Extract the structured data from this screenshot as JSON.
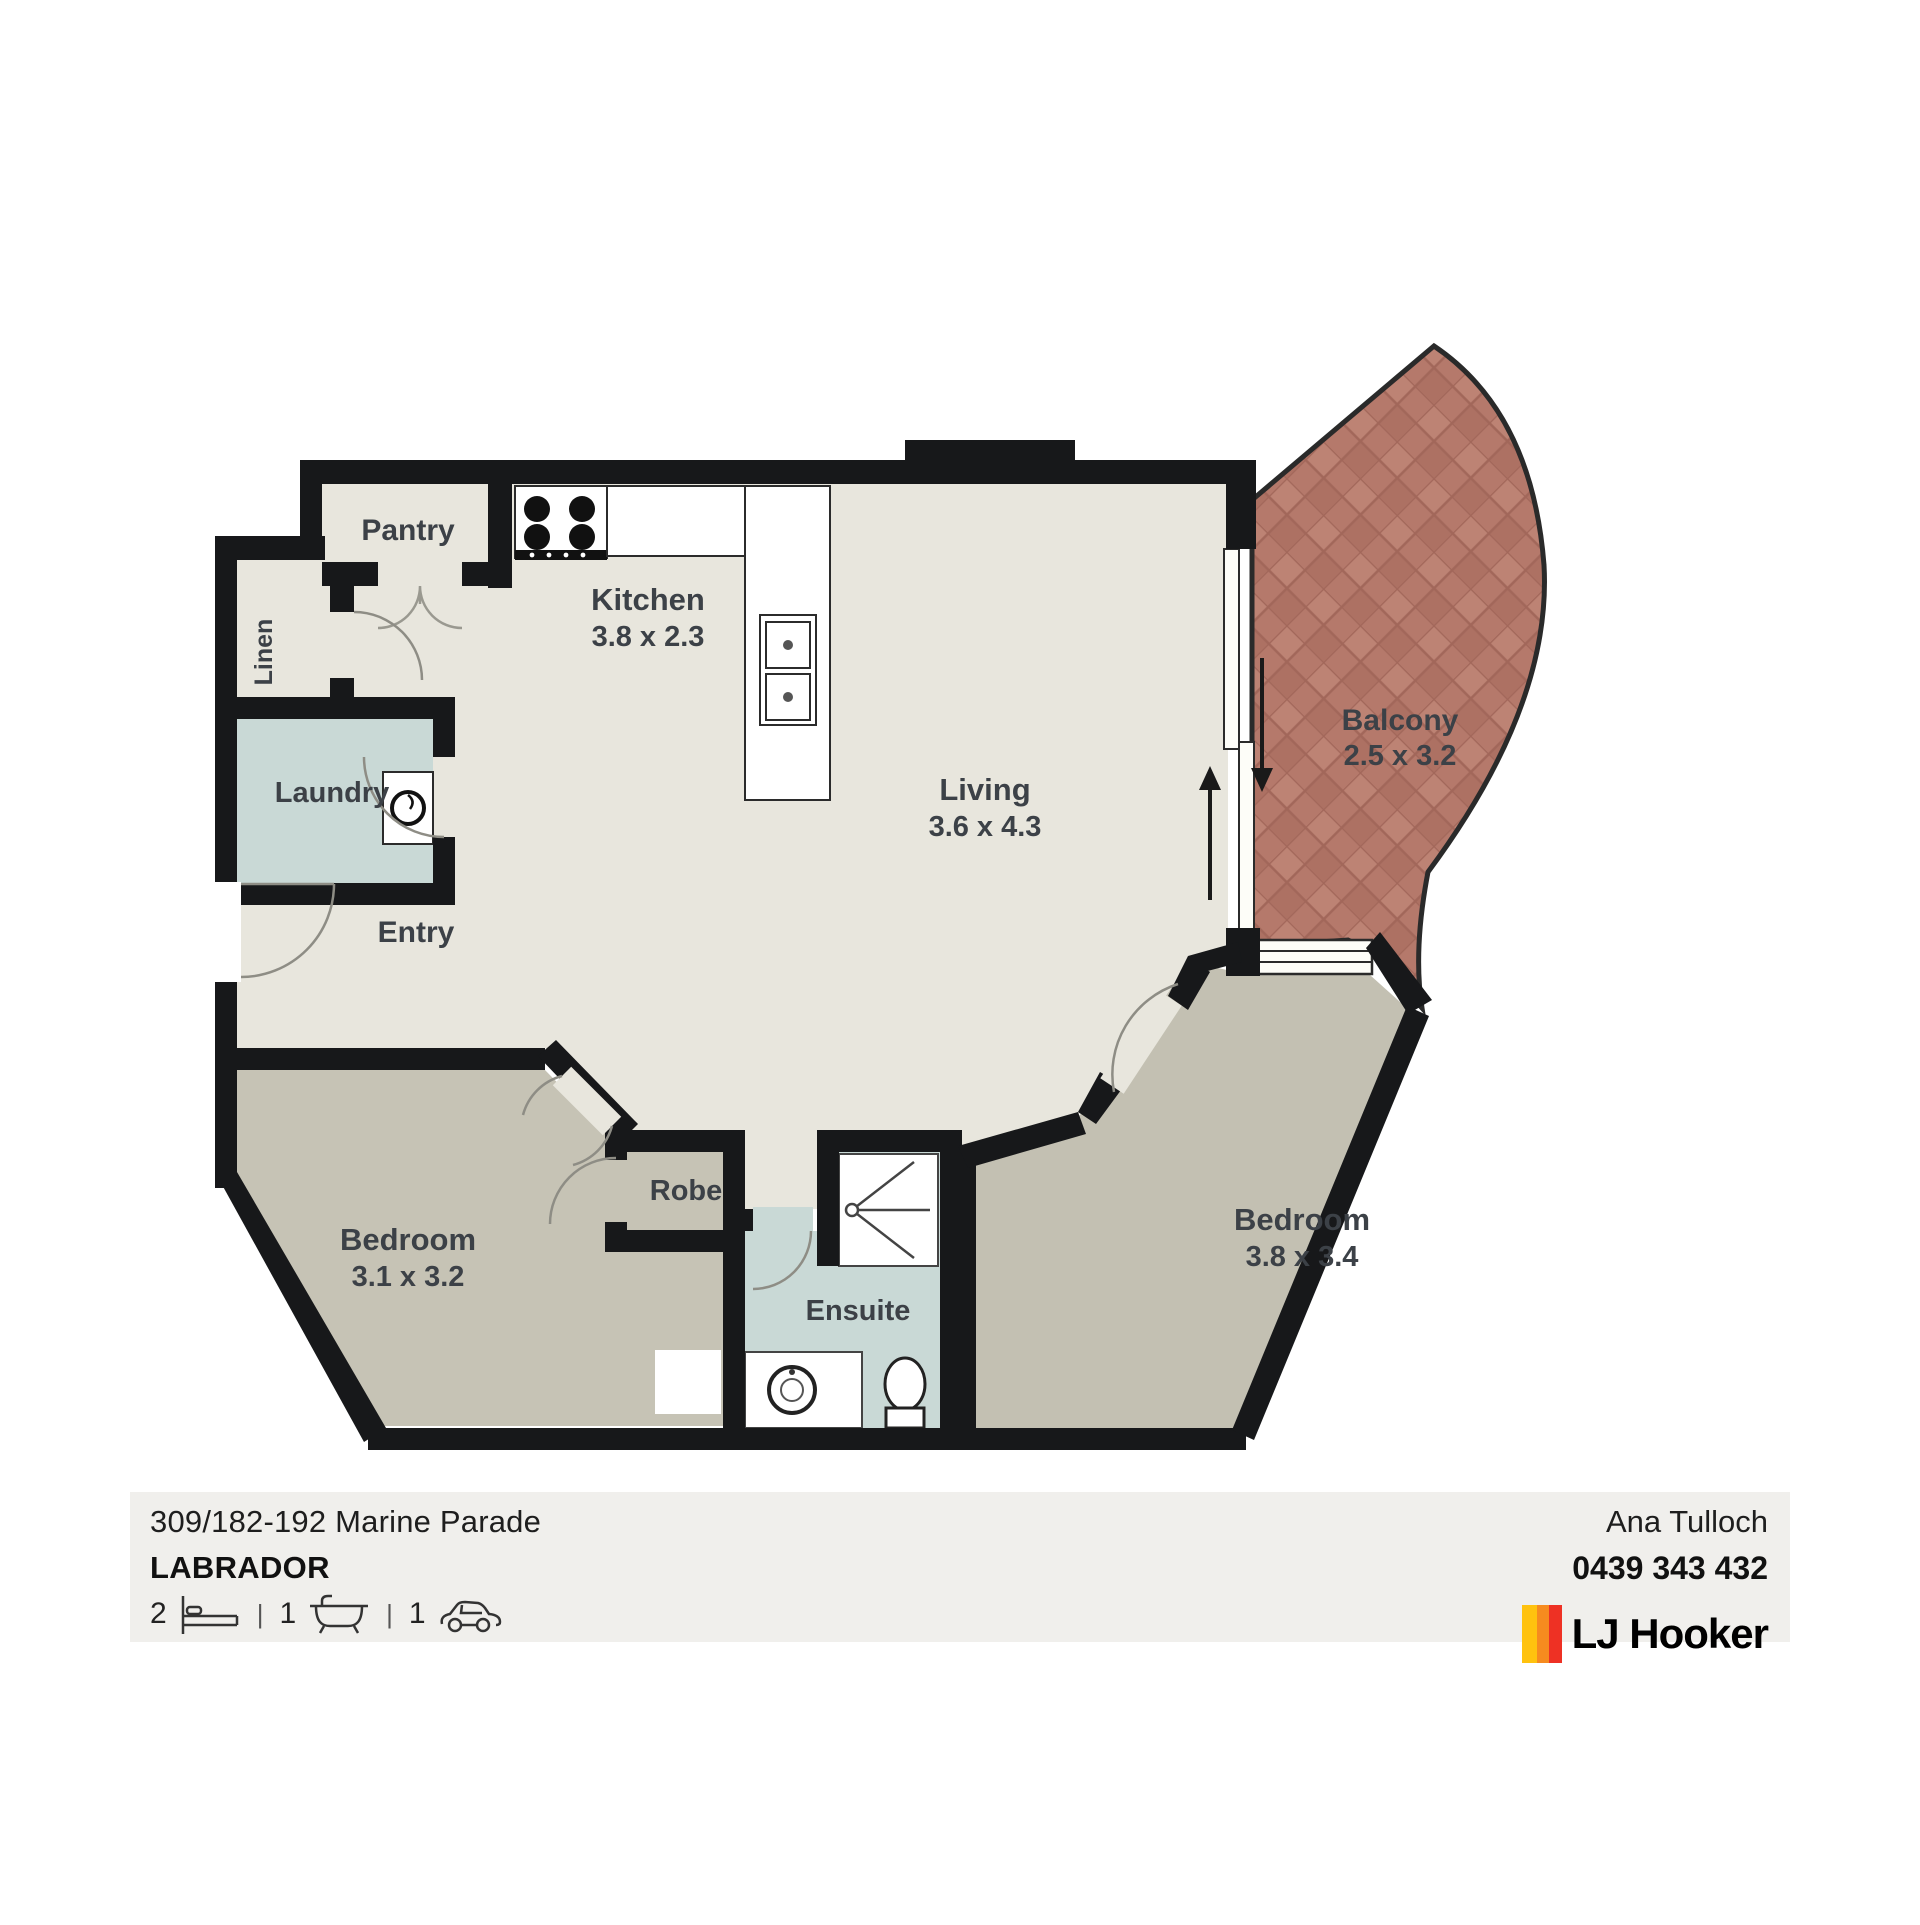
{
  "plan": {
    "rooms": {
      "pantry": {
        "label": "Pantry"
      },
      "linen": {
        "label": "Linen"
      },
      "kitchen": {
        "label": "Kitchen",
        "dims": "3.8 x 2.3"
      },
      "living": {
        "label": "Living",
        "dims": "3.6 x 4.3"
      },
      "laundry": {
        "label": "Laundry"
      },
      "entry": {
        "label": "Entry"
      },
      "balcony": {
        "label": "Balcony",
        "dims": "2.5 x 3.2"
      },
      "bedroom1": {
        "label": "Bedroom",
        "dims": "3.1 x 3.2"
      },
      "robe": {
        "label": "Robe"
      },
      "ensuite": {
        "label": "Ensuite"
      },
      "bedroom2": {
        "label": "Bedroom",
        "dims": "3.8 x 3.4"
      }
    },
    "colors": {
      "wall": "#17181a",
      "floor_light": "#e8e6dd",
      "floor_bedroom": "#c6c3b5",
      "floor_wet": "#c9d9d6",
      "balcony_brick": "#b5796b",
      "label_text": "#3c4147"
    }
  },
  "footer": {
    "address_line1": "309/182-192 Marine Parade",
    "suburb": "LABRADOR",
    "beds": "2",
    "baths": "1",
    "cars": "1",
    "agent_name": "Ana Tulloch",
    "agent_phone": "0439 343 432",
    "brand_name": "LJ Hooker",
    "brand_colors": [
      "#ffc20e",
      "#f68b1f",
      "#ee3124"
    ]
  }
}
